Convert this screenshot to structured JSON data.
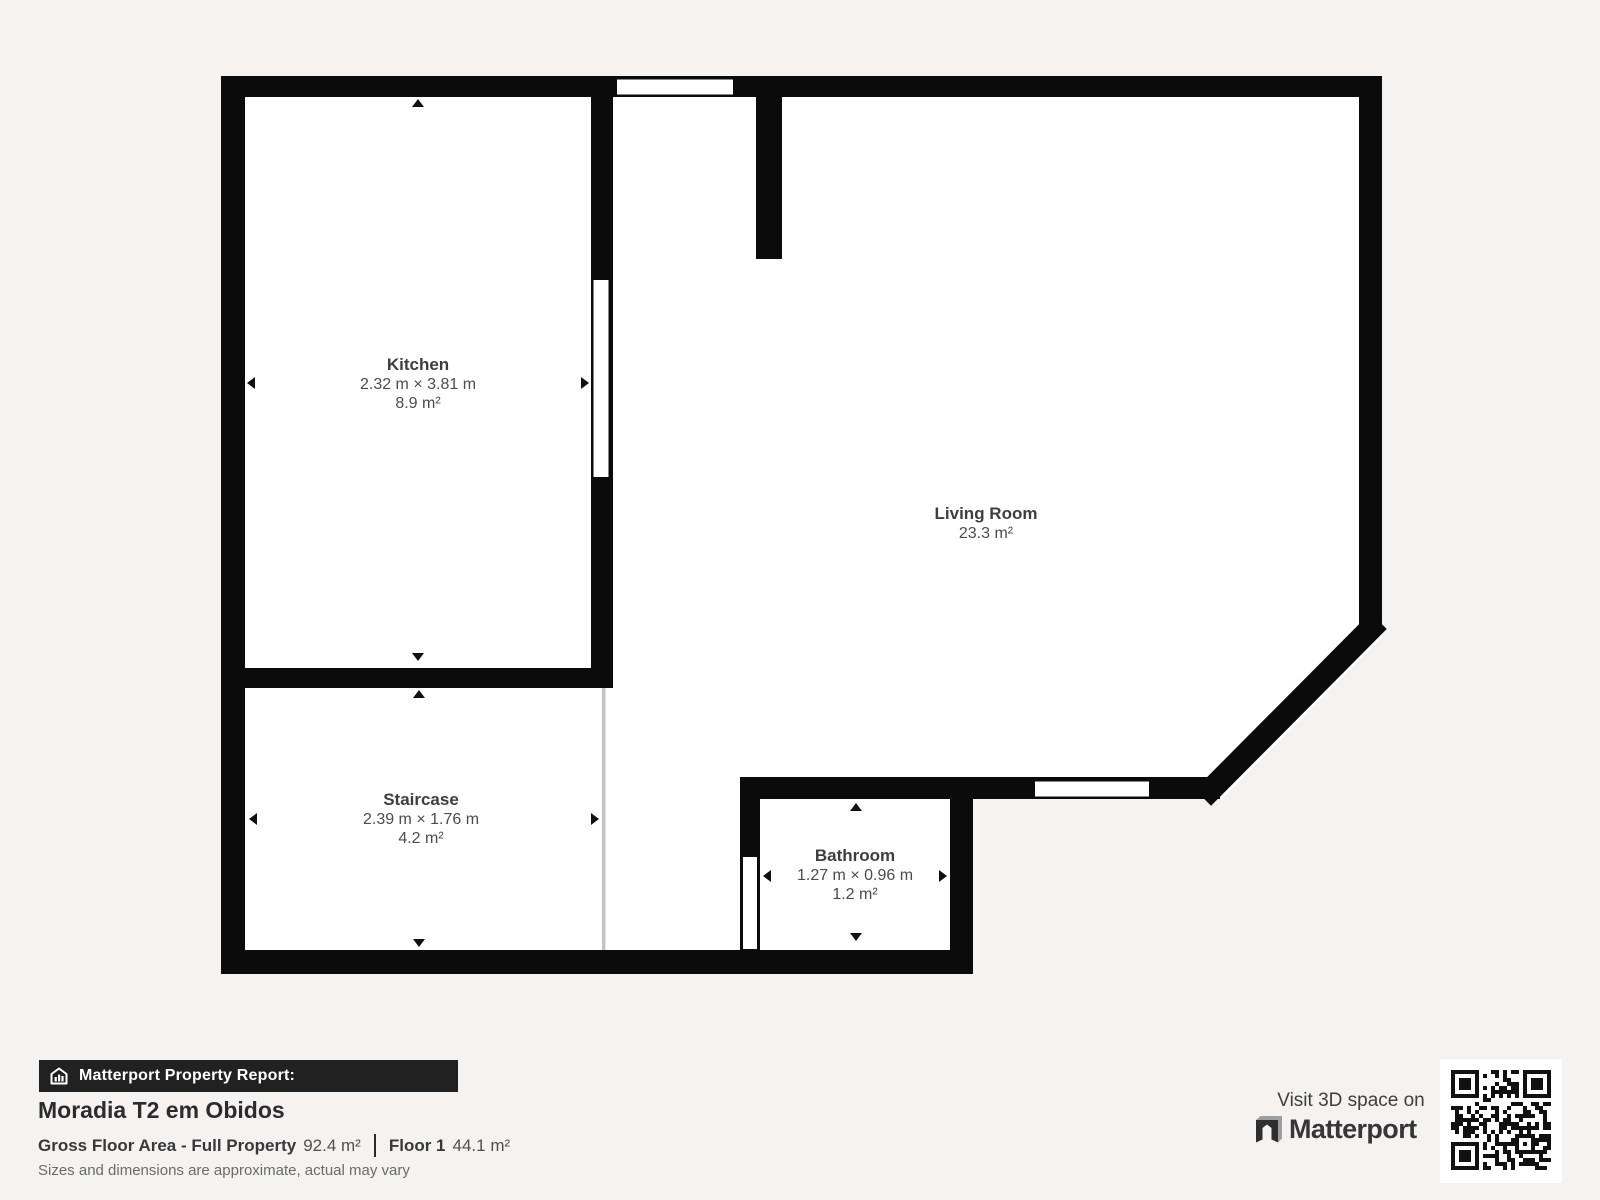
{
  "colors": {
    "background": "#f4f3f1",
    "wall": "#0b0b0b",
    "banner_background": "#212121",
    "room_text": "#3e3e3e"
  },
  "plan": {
    "rooms": [
      {
        "id": "kitchen",
        "name": "Kitchen",
        "dimensions": "2.32 m × 3.81 m",
        "area": "8.9 m²"
      },
      {
        "id": "living-room",
        "name": "Living Room",
        "dimensions": "",
        "area": "23.3 m²"
      },
      {
        "id": "staircase",
        "name": "Staircase",
        "dimensions": "2.39 m × 1.76 m",
        "area": "4.2 m²"
      },
      {
        "id": "bathroom",
        "name": "Bathroom",
        "dimensions": "1.27 m × 0.96 m",
        "area": "1.2 m²"
      }
    ]
  },
  "report": {
    "banner_label": "Matterport Property Report:",
    "property_name": "Moradia T2 em Obidos",
    "gross_label": "Gross Floor Area - Full Property",
    "gross_value": "92.4 m²",
    "floor_label": "Floor 1",
    "floor_value": "44.1 m²",
    "disclaimer": "Sizes and dimensions are approximate, actual may vary"
  },
  "footer_right": {
    "visit_text": "Visit 3D space on",
    "brand": "Matterport"
  }
}
